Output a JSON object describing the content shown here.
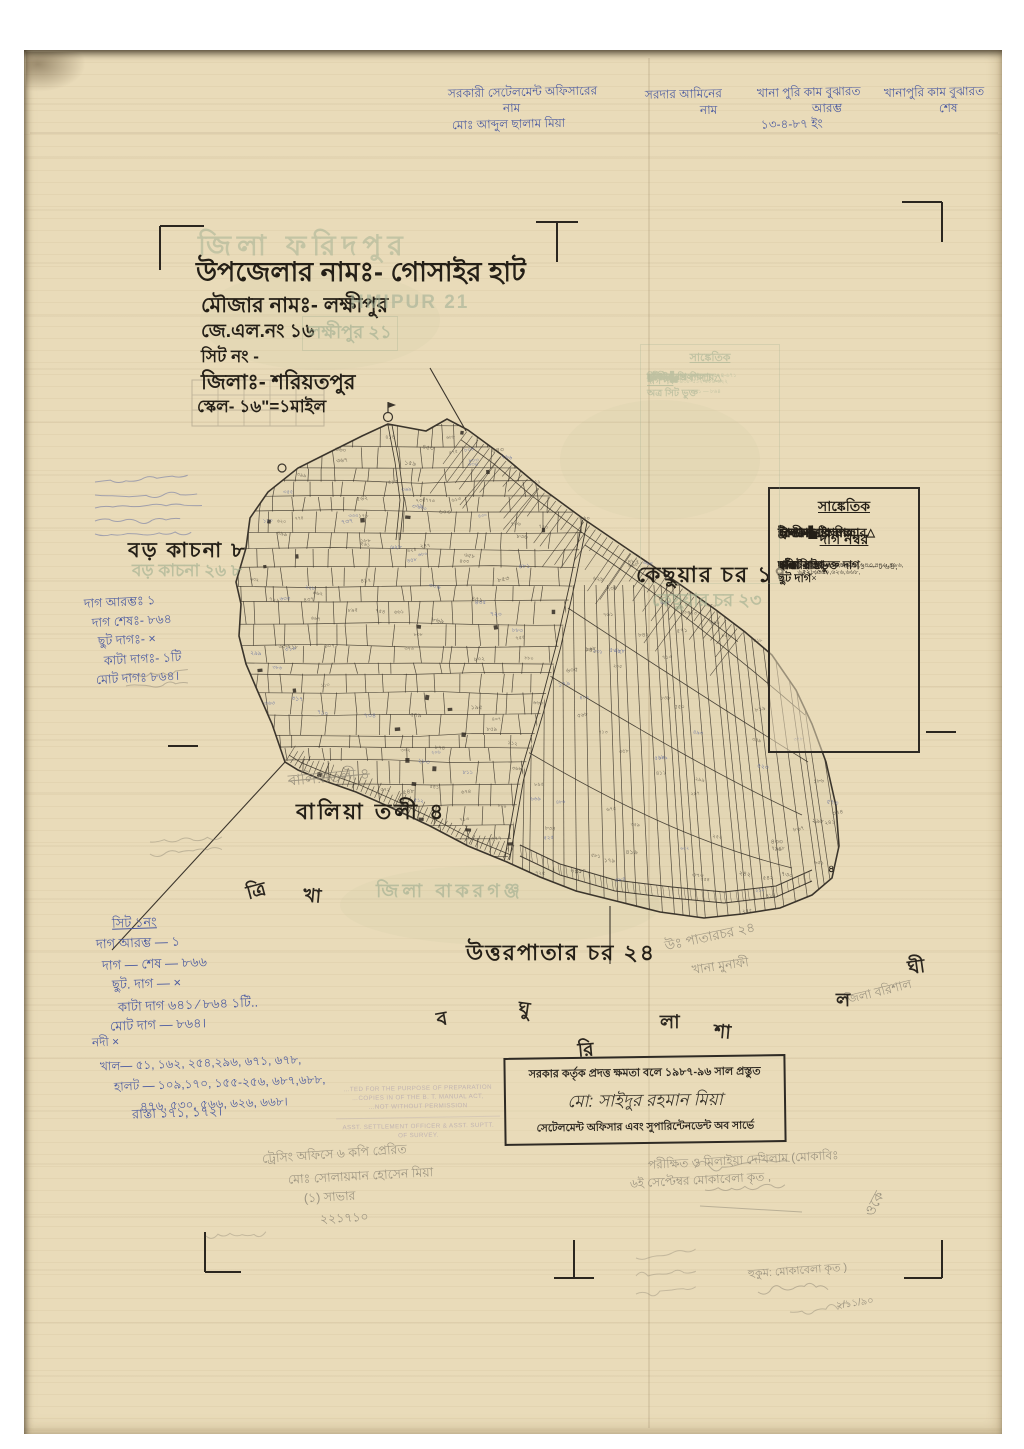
{
  "colors": {
    "paper": "#e9dbb9",
    "ink": "#2b261f",
    "blue_ink": "#4c5ba0",
    "pencil": "#8b8474",
    "ghost_green": "#9fae90",
    "ghost_purple": "#a093ab"
  },
  "top_annotations": {
    "columns": [
      {
        "lines": [
          "সরকারী সেটেলমেন্ট অফিসারের",
          "নাম",
          "মোঃ আব্দুল ছালাম মিয়া"
        ]
      },
      {
        "lines": [
          "সরদার আমিনের",
          "নাম"
        ]
      },
      {
        "lines": [
          "খানা পুরি কাম বুঝারত",
          "আরম্ভ",
          "১৩-৪-৮৭ ইং"
        ]
      },
      {
        "lines": [
          "খানাপুরি কাম বুঝারত",
          "শেষ"
        ]
      }
    ]
  },
  "title_block": {
    "ghost_district": "জিলা ফরিদপুর",
    "upazila_line": "উপজেলার নামঃ- গোসাইর হাট",
    "mouza_line": "মৌজার নামঃ- লক্ষীপুর",
    "mouza_ghost_latin": "HMIPUR 21",
    "jl_line": "জে.এল.নং ১৬",
    "jl_ghost": "লক্ষীপুর ২১",
    "sheet_line": "সিট নং -",
    "district_line": "জিলাঃ- শরিয়তপুর",
    "scale_line": "স্কেল- ১৬\"=১মাইল"
  },
  "map_labels": {
    "boro_kachna": "বড় কাচনা ৮",
    "boro_kachna_ghost": "বড় কাচনা ২৬ ৮",
    "kechhuar_char": "কেছুয়ার চর ১৭",
    "kechhuar_char_ghost": "কেছুয়ার চর ২৩",
    "balia_toli": "বালিয়া তলী ৪",
    "balia_toli_pencil": "বালিয়াতলী  ৪",
    "zila_bakarganj_ghost": "জিলা বাকরগঞ্জ",
    "uttarpatar_char": "উত্তরপাতার চর ২৪",
    "uttarpatar_pencil": "উঃ পাতারচর ২৪",
    "khana_pencil": "খানা মুনাফী",
    "zila_barishal_pencil": "জিলা বরিশাল",
    "tail_tip_digit": "৪"
  },
  "scattered_letters": [
    "ত্রি",
    "খা",
    "ব",
    "ঘু",
    "রি",
    "লা",
    "শা",
    "ল",
    "ঘী"
  ],
  "legend": {
    "title": "সাঙ্কেতিক",
    "symbol_rows": [
      {
        "label": "দালান",
        "symbol": "▙"
      },
      {
        "label": "ত্রিসীমানার পিলার",
        "symbol": "△"
      },
      {
        "label": "অন্যান্য পিলার",
        "symbol": "⊡"
      },
      {
        "label": "ট্রাভার্স ষ্টেশন",
        "symbol": "⊙"
      },
      {
        "label": "ইন্দারা",
        "symbol": "◉"
      }
    ],
    "section2_title": "দাগ নম্বর",
    "number_rows": [
      {
        "label": "পাকা রাস্তা",
        "value": "×"
      },
      {
        "label": "কাঁচা রাস্তা",
        "value": "১৭১, ১৭২,"
      },
      {
        "label": "হালট",
        "value": "১০৯,১৭০,১৫৫,২৫৬,৬৪৩,৪৭৬,৪৯৬, ৫২৮,৫৬০,৬২৬,৬৬৮,"
      },
      {
        "label": "নদী",
        "value": "×"
      },
      {
        "label": "খাল",
        "value": "৫১, ১৬২, ২৫৪, ২৯৬, ৬২২, ৬৭৫,"
      },
      {
        "label": "অত্র সিট ভুক্ত দাগ",
        "value": "১ — ৮৬৪,"
      },
      {
        "label": "ছুট দাগ",
        "value": "×"
      }
    ]
  },
  "ghost_legend": {
    "title": "সাঙ্কেতিক",
    "rows": [
      {
        "label": "দালান",
        "value": "▙"
      },
      {
        "label": "ত্রিসীমানার পিলার",
        "value": "△"
      },
      {
        "label": "অন্যান্য পিলার",
        "value": "▢"
      },
      {
        "label": "ষ্টেশন",
        "value": "○ ○"
      },
      {
        "label": "দাগ নং",
        "value": ""
      },
      {
        "label": "হালট",
        "value": "৯৬-১৯৩-২৬৮-২৯৮-৩১৪- ৩৯৬-৪৩৮-৫১২-৫৮৪-৬২২"
      },
      {
        "label": "নদী",
        "value": "×"
      },
      {
        "label": "খাল",
        "value": "১৫০-২৫৪-২৯৬-৩৬৪-৫২২-৬৭১"
      },
      {
        "label": "অত্র সিট ভুক্ত",
        "value": "১ — ৮৬৪"
      },
      {
        "label": "ছুট দাগ",
        "value": "১৯২"
      }
    ]
  },
  "notes_upper_left": [
    "দাগ আরম্ভঃ  ১",
    "দাগ শেষঃ- ৮৬৪",
    "ছুট দাগঃ-  ×",
    "কাটা দাগঃ- ১টি",
    "মোট দাগঃ  ৮৬৪।"
  ],
  "notes_lower_left": {
    "header": "সিট ১নং",
    "lines": [
      "দাগ আরম্ভ —  ১",
      "দাগ — শেষ —  ৮৬৬",
      "ছুট. দাগ —   ×",
      "কাটা দাগ  ৬৪১ ⁄ ৮৬৪  ১টি..",
      "মোট দাগ —  ৮৬৪।"
    ],
    "water_lines": [
      "নদী      ×",
      "খাল— ৫১, ১৬২, ২৫৪,২৯৬, ৬৭১, ৬৭৮,",
      "হালট — ১০৯,১৭০, ১৫৫-২৫৬, ৬৮৭,৬৮৮,",
      "৪৭৬, ৫৩০, ৫৬৬, ৬২৬, ৬৬৮।"
    ],
    "road_line": "রাস্তা  ১৭১,  ১৭২।"
  },
  "stamp_box": {
    "line1": "সরকার কর্তৃক প্রদত্ত ক্ষমতা বলে ১৯৮৭-৯৬ সাল প্রস্তুত",
    "line2": "মো: সাইদুর রহমান মিয়া",
    "line3": "সেটেলমেন্ট অফিসার এবং সুপারিন্টেনডেন্ট অব সার্ভে"
  },
  "pencil_notes": {
    "tracing": "ট্রেসিং অফিসে ৬ কপি প্রেরিত",
    "clerk_lines": [
      "মোঃ সোলায়মান হোসেন মিয়া",
      "(১) সাভার",
      "২২১৭১০"
    ],
    "check_lines": [
      "পরীক্ষিত ও মিলাইয়া দেখিলাম (মোকাবিঃ",
      "৬ই সেপ্টেম্বর মোকাবেলা কৃত ,"
    ],
    "ok": "ওকে",
    "order_line": "হুকুম: মোকাবেলা কৃত )",
    "date": "২/১১/৯০"
  },
  "english_ghost_stamp": {
    "lines": [
      "…TED FOR THE PURPOSE OF PREPARATION",
      "…COPIES IN OF THE B. T. MANUAL ACT,",
      "…NOT WITHOUT PERMISSION",
      "ASST. SETTLEMENT OFFICER & ASST. SUPTT.",
      "OF SURVEY."
    ]
  }
}
